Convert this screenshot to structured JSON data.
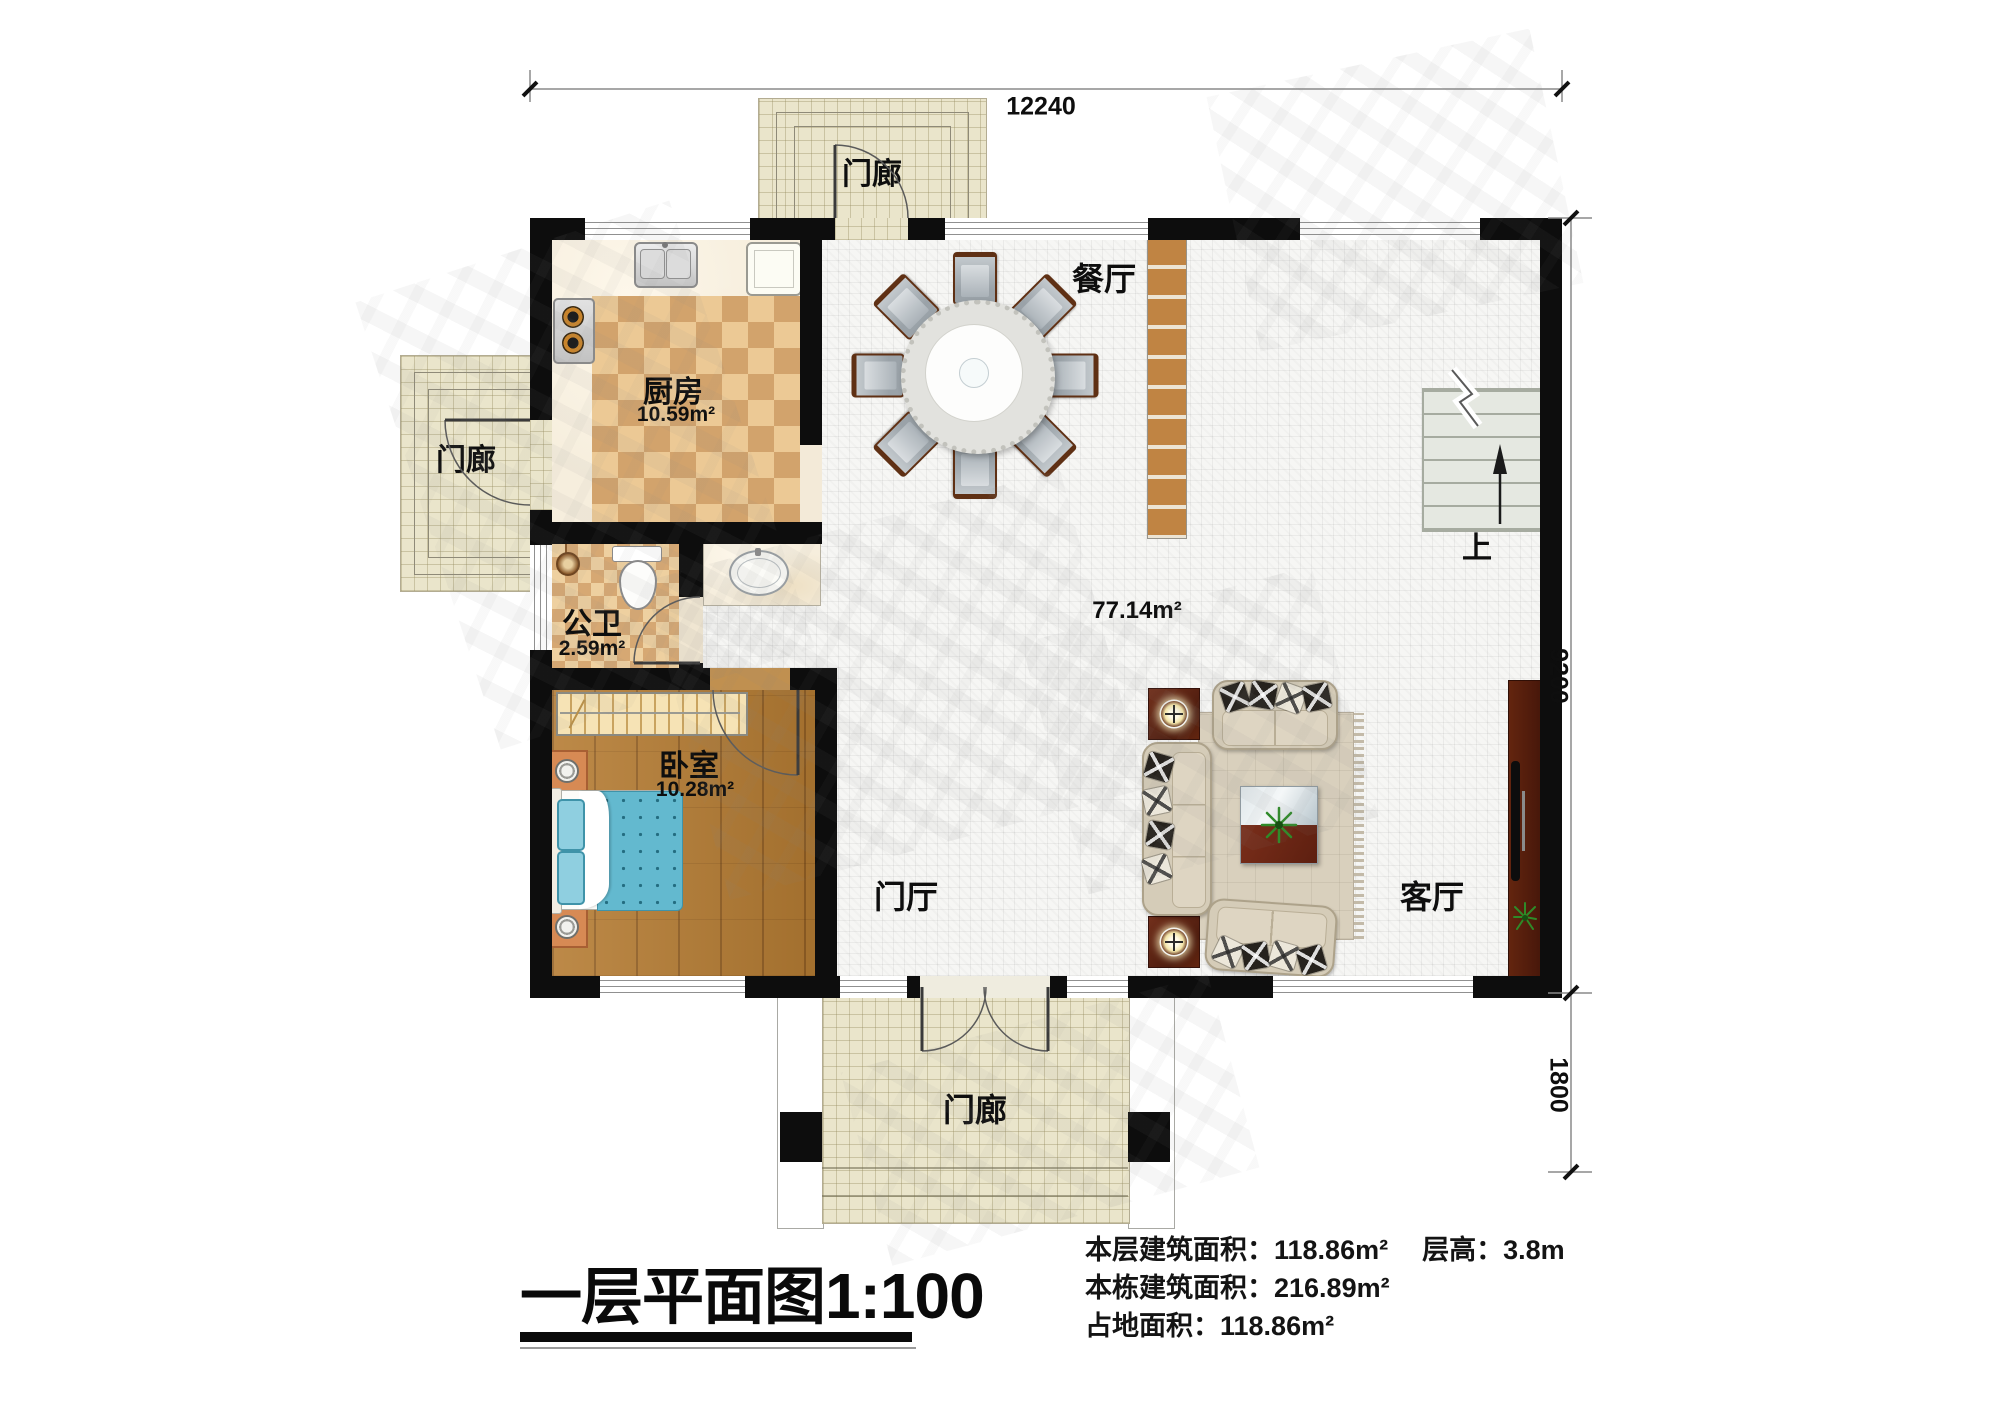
{
  "plan": {
    "title": "一层平面图",
    "scale": "1:100"
  },
  "dimensions": {
    "top_width": "12240",
    "right_height": "9200",
    "porch_depth": "1800"
  },
  "rooms": {
    "porch_top": "门廊",
    "porch_left": "门廊",
    "porch_bottom": "门廊",
    "dining": "餐厅",
    "kitchen": "厨房",
    "kitchen_area": "10.59m²",
    "bathroom": "公卫",
    "bathroom_area": "2.59m²",
    "bedroom": "卧室",
    "bedroom_area": "10.28m²",
    "hall_area": "77.14m²",
    "foyer": "门厅",
    "living": "客厅",
    "stairs_up": "上"
  },
  "info": {
    "floor_area_label": "本层建筑面积：",
    "floor_area_value": "118.86m²",
    "story_height_label": "层高：",
    "story_height_value": "3.8m",
    "building_area_label": "本栋建筑面积：",
    "building_area_value": "216.89m²",
    "footprint_label": "占地面积：",
    "footprint_value": "118.86m²"
  }
}
